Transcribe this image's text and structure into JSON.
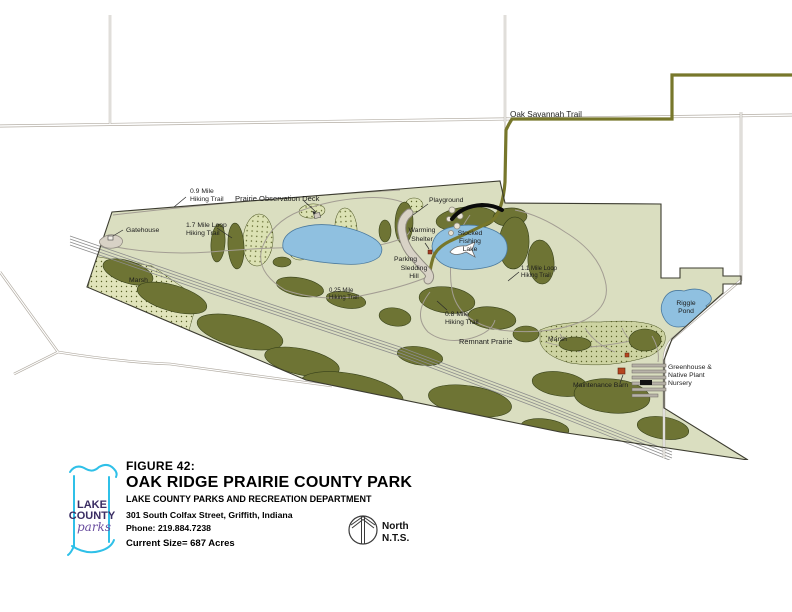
{
  "figure": {
    "figure_no": "FIGURE 42:",
    "title": "OAK RIDGE PRAIRIE COUNTY PARK",
    "department": "LAKE COUNTY PARKS AND RECREATION DEPARTMENT",
    "address": "301 South Colfax Street, Griffith, Indiana",
    "phone": "Phone:  219.884.7238",
    "size": "Current Size= 687 Acres"
  },
  "north_arrow": {
    "label": "North",
    "scale": "N.T.S."
  },
  "logo": {
    "line1": "LAKE",
    "line2": "COUNTY",
    "script": "parks"
  },
  "map": {
    "labels": {
      "oak_savannah_trail": "Oak Savannah Trail",
      "gatehouse": "Gatehouse",
      "trail_09_l1": "0.9 Mile",
      "trail_09_l2": "Hiking Trail",
      "observation_deck": "Prairie Observation Deck",
      "loop_17_l1": "1.7 Mile Loop",
      "loop_17_l2": "Hiking Trail",
      "marsh_west": "Marsh",
      "playground": "Playground",
      "warming_l1": "Warming",
      "warming_l2": "Shelter",
      "stocked_l1": "Stocked",
      "stocked_l2": "Fishing",
      "stocked_l3": "Lake",
      "parking": "Parking",
      "sledding_l1": "Sledding",
      "sledding_l2": "Hill",
      "loop_11_l1": "1.1 Mile Loop",
      "loop_11_l2": "Hiking Trail",
      "trail_025_l1": "0.25 Mile",
      "trail_025_l2": "Hiking Trail",
      "trail_08_l1": "0.8 Mile",
      "trail_08_l2": "Hiking Trail",
      "remnant_prairie": "Remnant Prairie",
      "marsh_east": "Marsh",
      "riggle_l1": "Riggle",
      "riggle_l2": "Pond",
      "greenhouse_l1": "Greenhouse &",
      "greenhouse_l2": "Native Plant",
      "greenhouse_l3": "Nursery",
      "maintenance_barn": "Maintenance Barn"
    },
    "colors": {
      "park_fill": "#dadec0",
      "vegetation": "#6e7434",
      "marsh_west_fill": "#e1e4bb",
      "marsh_east_fill": "#cdd3a2",
      "stipple_fill": "#dce2b4",
      "water": "#8fc0e0",
      "oak_savannah_trail": "#77772b",
      "road": "#b3ada4",
      "railroad": "#8d8d8d",
      "barn": "#b5451f",
      "logo_cyan": "#2fc0e8",
      "logo_purple": "#3a2d63"
    }
  }
}
